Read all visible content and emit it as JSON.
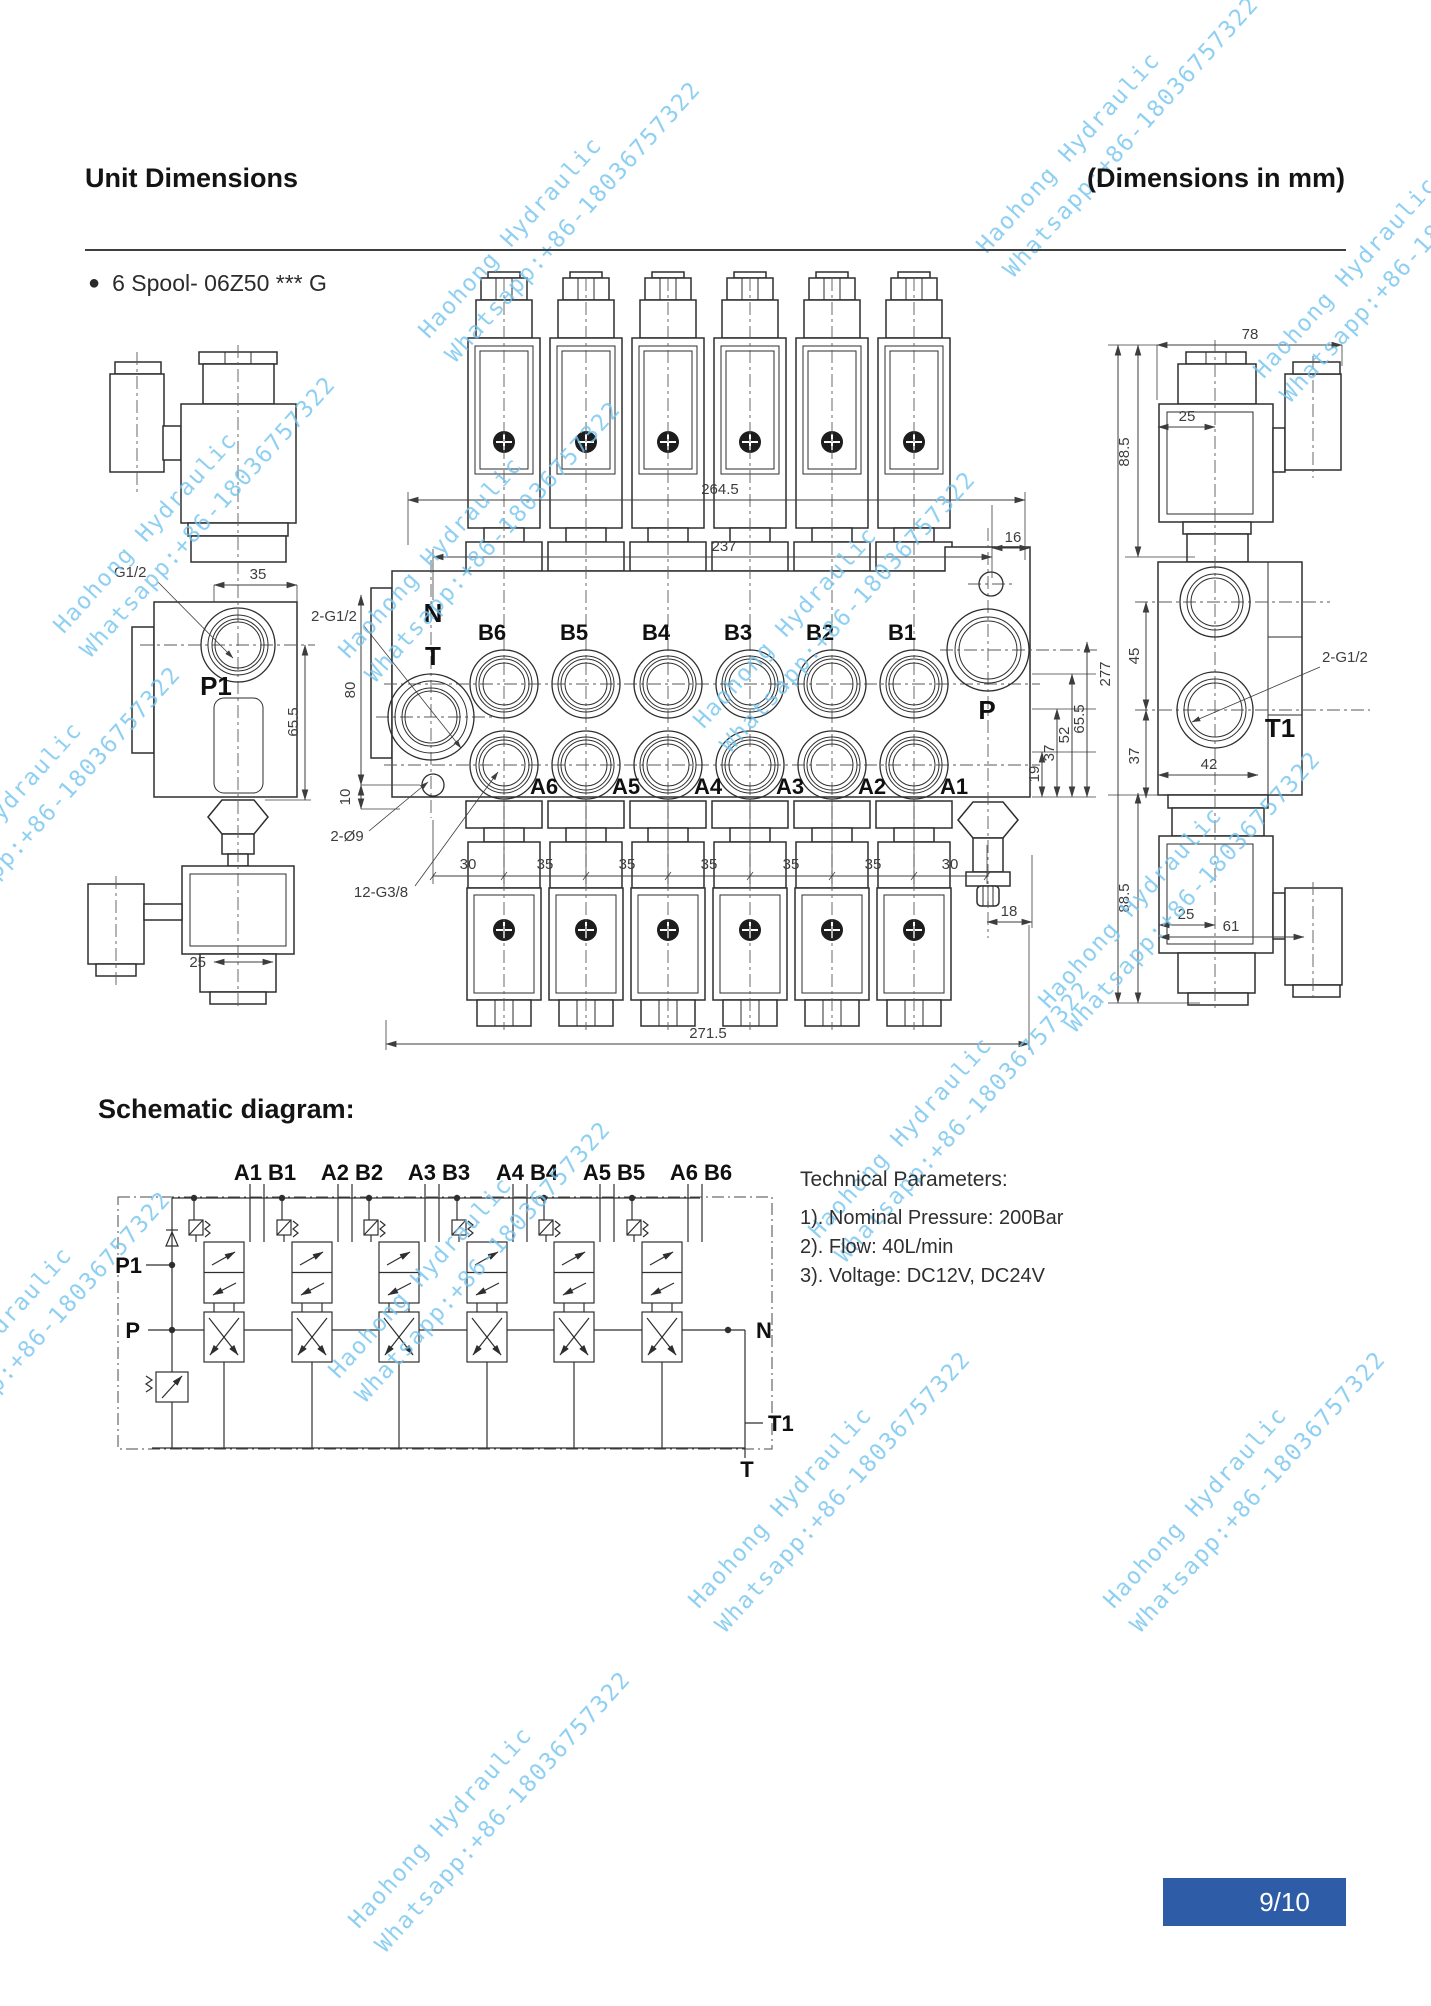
{
  "header": {
    "title": "Unit Dimensions",
    "right": "(Dimensions in mm)",
    "bullet": "6 Spool- 06Z50 *** G"
  },
  "schematic_heading": "Schematic diagram:",
  "tech": {
    "title": "Technical Parameters:",
    "items": [
      "1). Nominal Pressure: 200Bar",
      "2). Flow: 40L/min",
      "3). Voltage: DC12V, DC24V"
    ]
  },
  "footer": {
    "page": "9/10",
    "badge_color": "#2e5ca6"
  },
  "watermark": {
    "line1": "Haohong Hydraulic",
    "line2": "Whatsapp:+86-18036757322",
    "color": "#74c5ef"
  },
  "front": {
    "n": "N",
    "t": "T",
    "p": "P",
    "b": [
      "B6",
      "B5",
      "B4",
      "B3",
      "B2",
      "B1"
    ],
    "a": [
      "A6",
      "A5",
      "A4",
      "A3",
      "A2",
      "A1"
    ],
    "d264": "264.5",
    "d237": "237",
    "d16": "16",
    "d271": "271.5",
    "d18": "18",
    "d80": "80",
    "d10": "10",
    "chain": [
      "19",
      "37",
      "52",
      "65.5"
    ],
    "pitch": [
      "30",
      "35",
      "35",
      "35",
      "35",
      "35",
      "30"
    ],
    "g12": "2-G1/2",
    "d9": "2-Ø9",
    "g38": "12-G3/8"
  },
  "left": {
    "g12": "G1/2",
    "d35": "35",
    "p1": "P1",
    "d65": "65.5",
    "d25": "25"
  },
  "right": {
    "d78": "78",
    "d25t": "25",
    "d885t": "88.5",
    "d45": "45",
    "d37": "37",
    "d277": "277",
    "d42": "42",
    "g12": "2-G1/2",
    "t1": "T1",
    "d885b": "88.5",
    "d25b": "25",
    "d61": "61"
  },
  "schematic": {
    "sections": [
      "A1 B1",
      "A2 B2",
      "A3 B3",
      "A4 B4",
      "A5 B5",
      "A6 B6"
    ],
    "p1": "P1",
    "p": "P",
    "n": "N",
    "t1": "T1",
    "t": "T"
  }
}
